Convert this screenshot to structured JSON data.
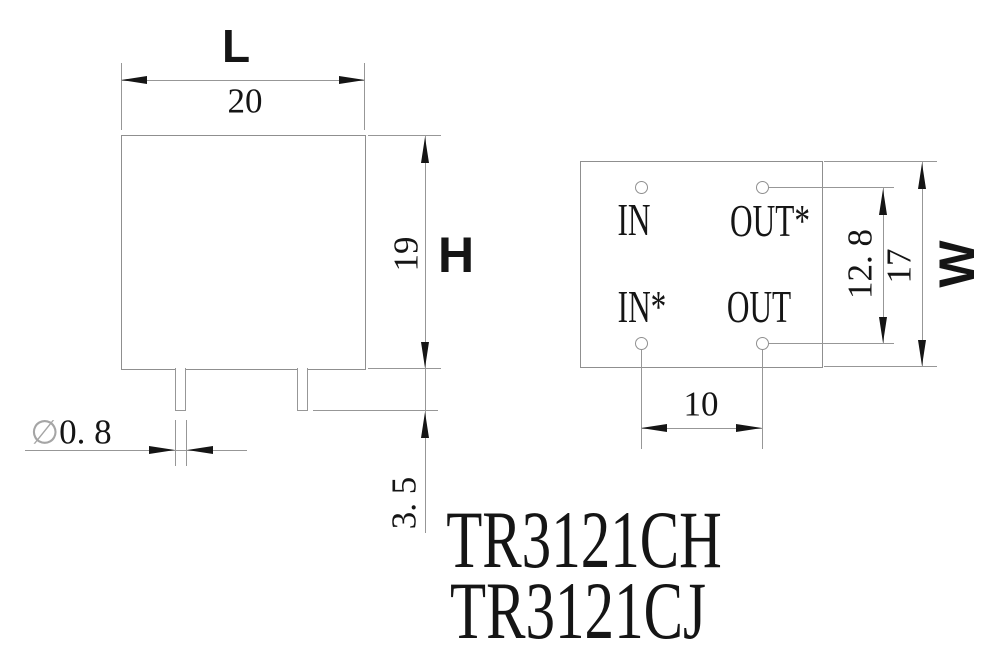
{
  "title": {
    "line1": "TR3121CH",
    "line2": "TR3121CJ"
  },
  "front_view": {
    "length_label": "L",
    "length_value": "20",
    "height_value": "19",
    "height_label": "H",
    "pin_length_value": "3. 5",
    "pin_diameter_symbol": "∅",
    "pin_diameter_value": "0. 8"
  },
  "bottom_view": {
    "pin_labels": {
      "top_left": "IN",
      "top_right": "OUT*",
      "bottom_left": "IN*",
      "bottom_right": "OUT"
    },
    "pin_row_spacing_value": "12. 8",
    "width_value": "17",
    "width_label": "W",
    "pin_column_spacing_value": "10"
  },
  "colors": {
    "line": "#979797",
    "ink": "#151515",
    "background": "#ffffff"
  }
}
